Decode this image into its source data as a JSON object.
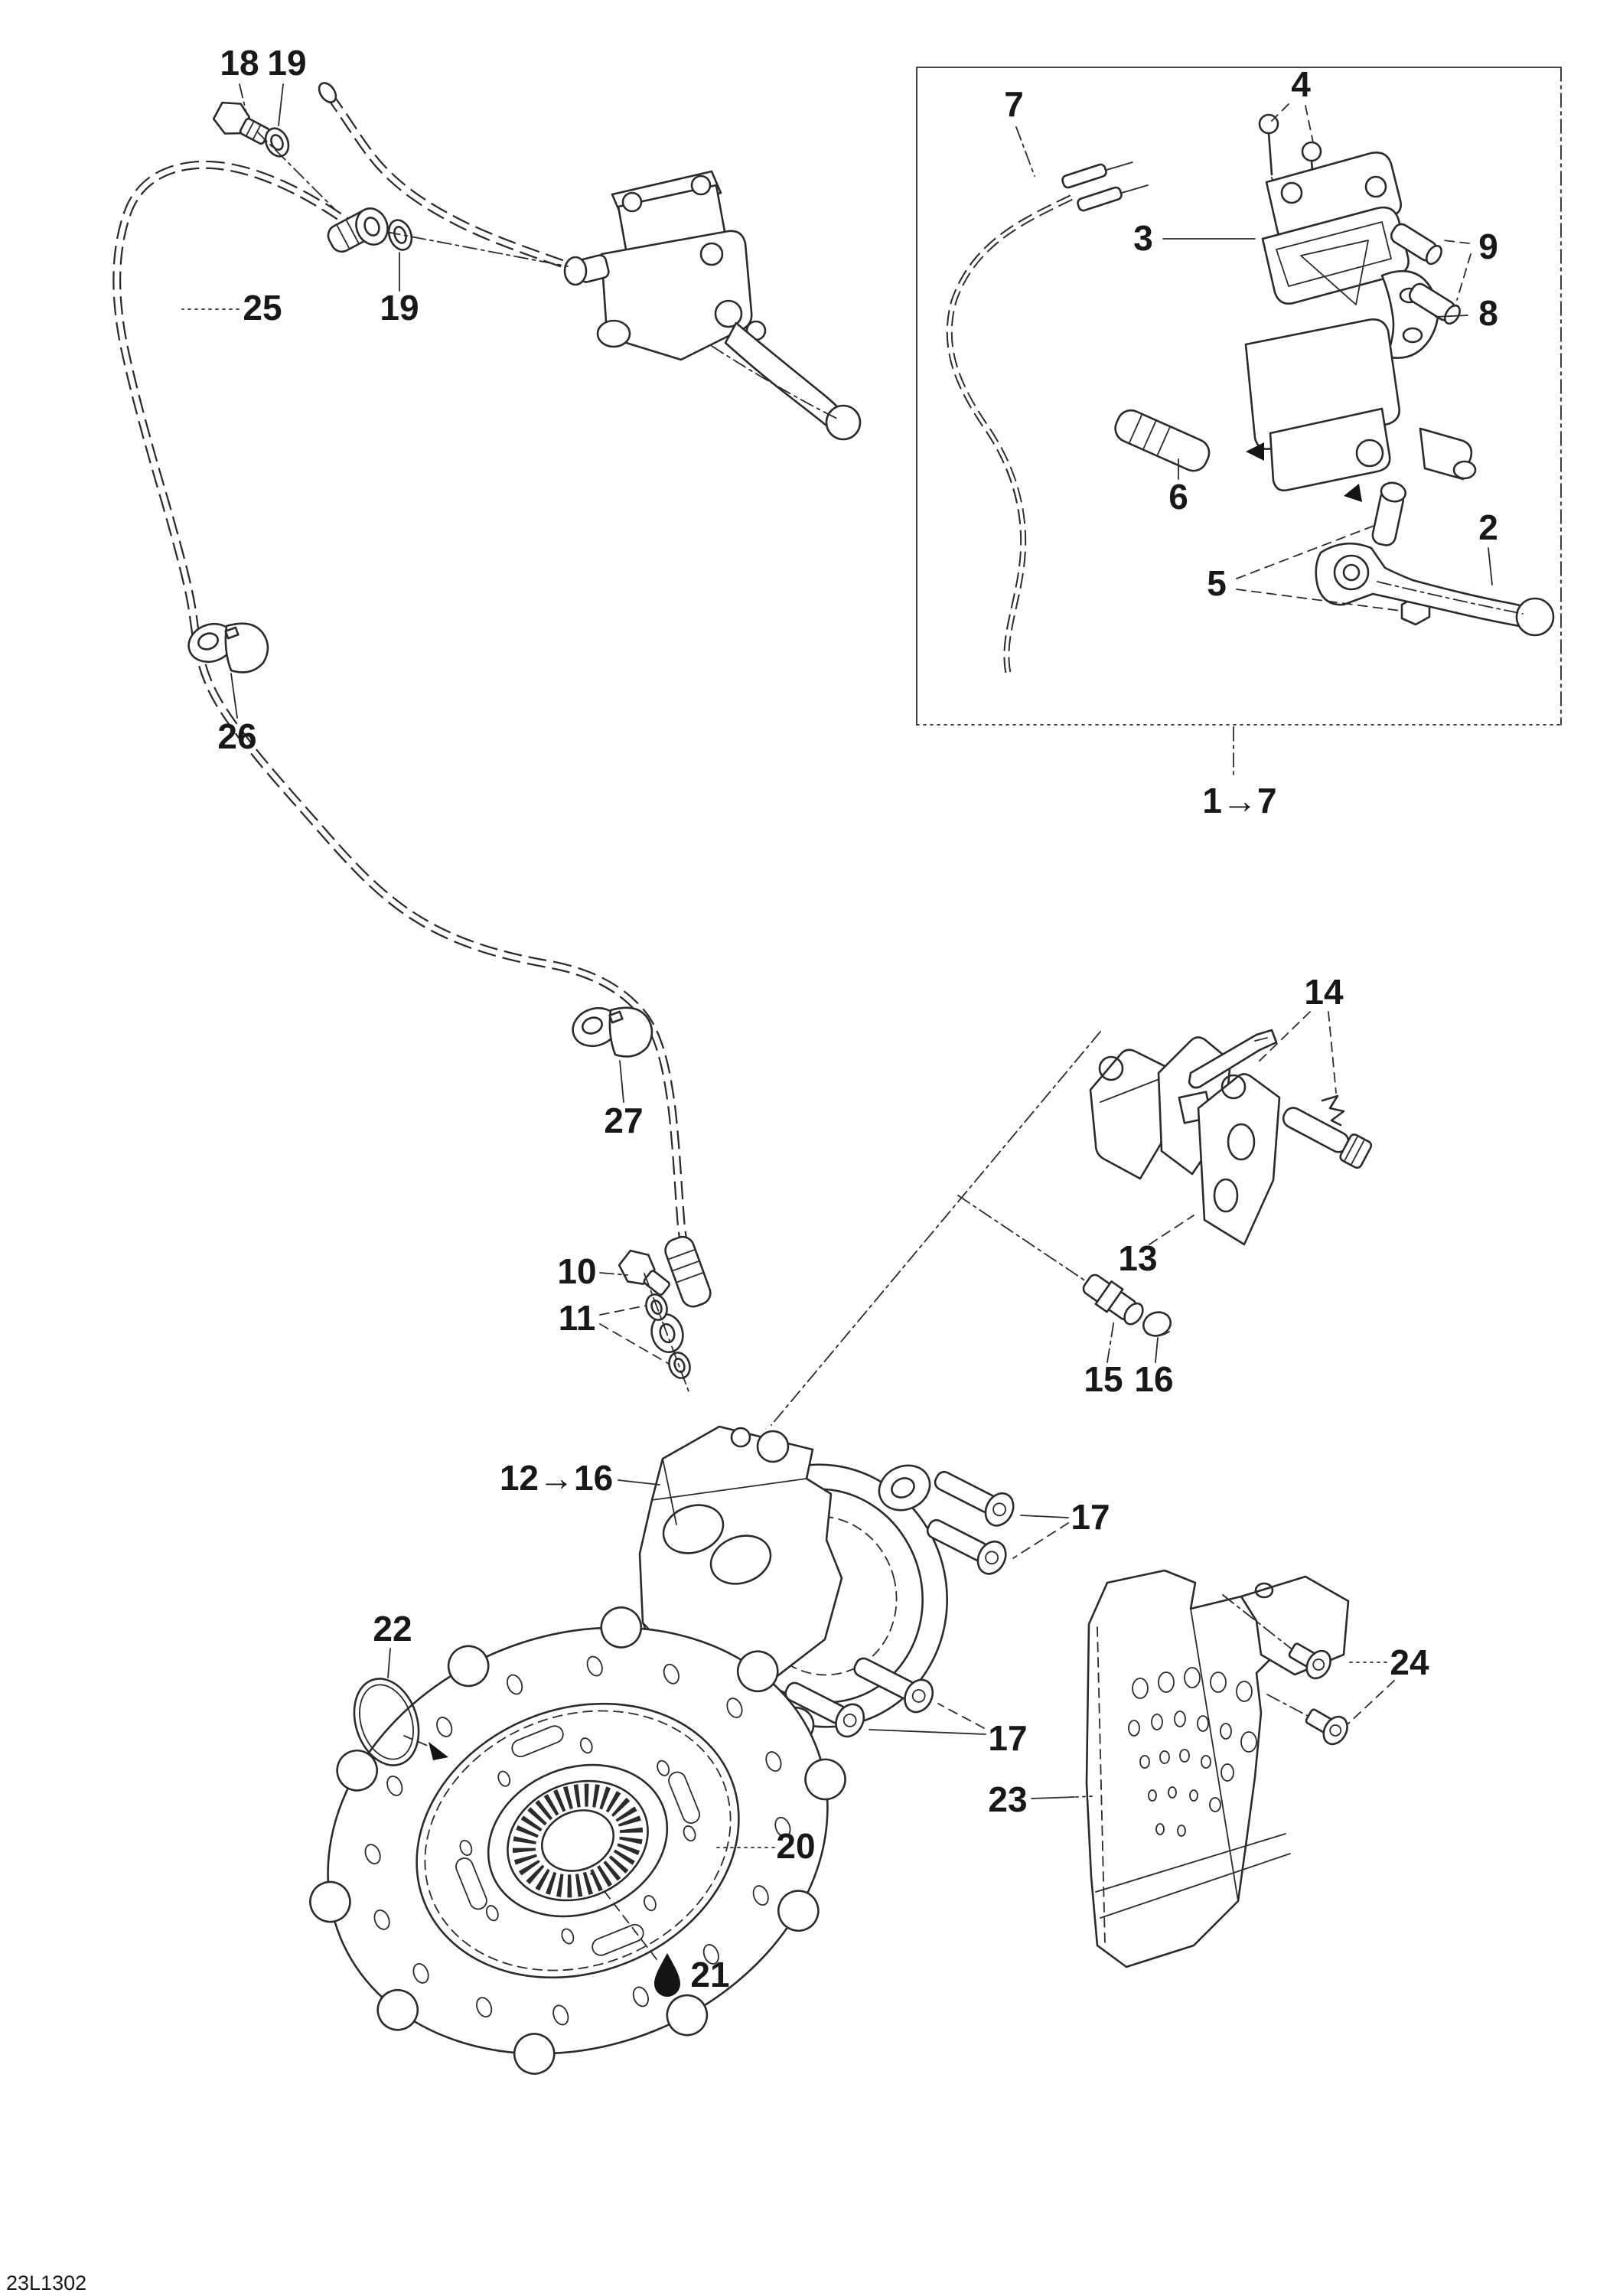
{
  "diagram": {
    "code": "23L1302",
    "brand": "Brembo",
    "labels": {
      "l18": "18",
      "l19a": "19",
      "l19b": "19",
      "l25": "25",
      "l26": "26",
      "l27": "27",
      "l7": "7",
      "l4": "4",
      "l3": "3",
      "l9": "9",
      "l8": "8",
      "l6": "6",
      "l5": "5",
      "l2": "2",
      "l1_7": "1→7",
      "l14": "14",
      "l13": "13",
      "l15": "15",
      "l16": "16",
      "l10": "10",
      "l11": "11",
      "l12_16": "12→16",
      "l17a": "17",
      "l17b": "17",
      "l22": "22",
      "l20": "20",
      "l21": "21",
      "l23": "23",
      "l24": "24"
    }
  }
}
